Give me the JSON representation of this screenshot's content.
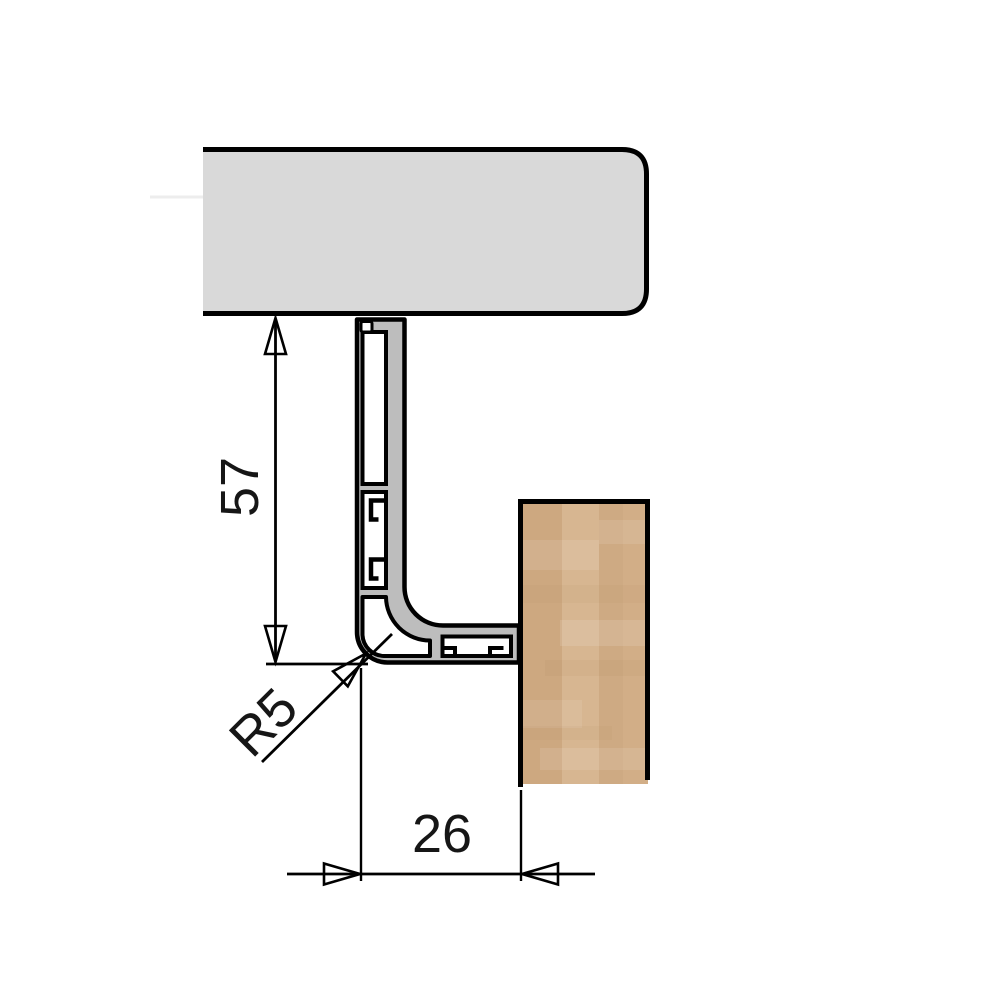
{
  "drawing": {
    "kind": "technical-cross-section",
    "dimensions": {
      "height_label": "57",
      "radius_label": "R5",
      "width_label": "26"
    },
    "colors": {
      "line": "#000000",
      "slab_fill": "#d9d9d9",
      "metal_fill": "#bdbdbd",
      "chamber_fill": "#ffffff",
      "wood_base": "#d2ae87",
      "wood_band_dark": "#c9a47a",
      "wood_band_light": "#dcbe9c",
      "faint_line": "#ededed",
      "text": "#161616"
    }
  }
}
